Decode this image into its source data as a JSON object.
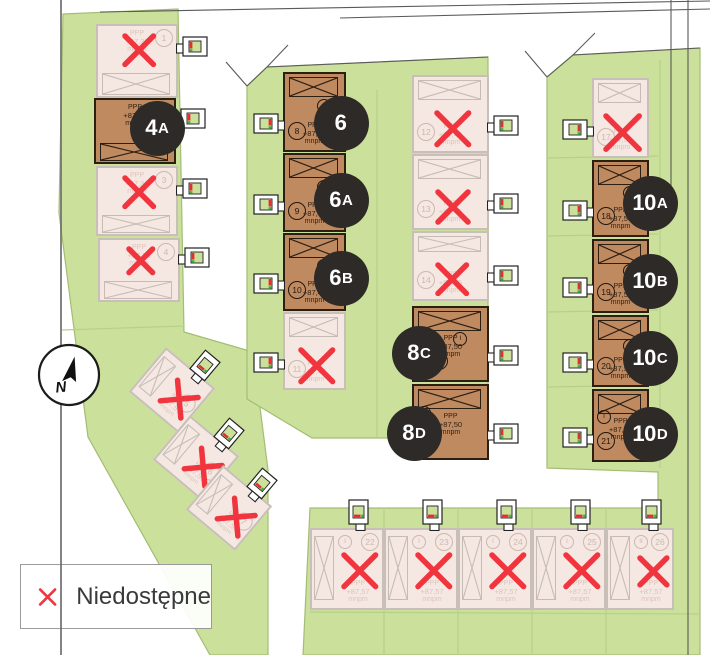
{
  "legend": {
    "label": "Niedostępne",
    "x_color": "#f0353f"
  },
  "compass": {
    "label": "N"
  },
  "colors": {
    "green": "#cbe19b",
    "green_border": "#a3bd74",
    "green_lines": "#b6d088",
    "road": "#ffffff",
    "available_fill": "#c08a61",
    "available_border": "#2b1f12",
    "unavailable_fill": "#f5e8e2",
    "unavailable_border": "#c8bfb9",
    "unavailable_x": "#f0353f",
    "label_circle": "#2d2a27",
    "label_text": "#ffffff",
    "boundary_line": "#6e6e6e"
  },
  "elevation_prefix": "PPP",
  "elevation_unit": "mnpm",
  "map": {
    "buildings": [
      {
        "plot": "1",
        "status": "unavailable",
        "x": 96,
        "y": 24,
        "w": 82,
        "h": 74,
        "hatch": "bottom",
        "drive": "right",
        "plot_pos": "tr",
        "tpos": "top",
        "elev": "+87,33"
      },
      {
        "name": "4A",
        "status": "available",
        "x": 94,
        "y": 98,
        "w": 82,
        "h": 66,
        "hatch": "bottom",
        "drive": "right",
        "tpos": "top",
        "elev": "+87,33",
        "label": [
          157,
          128
        ]
      },
      {
        "plot": "3",
        "status": "unavailable",
        "x": 96,
        "y": 166,
        "w": 82,
        "h": 70,
        "hatch": "bottom",
        "drive": "right",
        "plot_pos": "tr",
        "tpos": "top",
        "elev": "+87,33"
      },
      {
        "plot": "4",
        "status": "unavailable",
        "x": 98,
        "y": 238,
        "w": 82,
        "h": 64,
        "hatch": "bottom",
        "drive": "right",
        "plot_pos": "tr",
        "tpos": "top",
        "elev": "+87,33"
      },
      {
        "name": "6",
        "plot": "8",
        "roman": "I",
        "roman_pos": "mid",
        "status": "available",
        "x": 283,
        "y": 72,
        "w": 63,
        "h": 80,
        "hatch": "top",
        "drive": "left",
        "plot_pos": "bl",
        "tpos": "bottom",
        "elev": "+87,45",
        "label": [
          341,
          123
        ]
      },
      {
        "name": "6A",
        "plot": "9",
        "roman": "II",
        "roman_pos": "mid",
        "status": "available",
        "x": 283,
        "y": 153,
        "w": 63,
        "h": 79,
        "hatch": "top",
        "drive": "left",
        "plot_pos": "bl",
        "tpos": "bottom",
        "elev": "+87,45",
        "label": [
          341,
          200
        ]
      },
      {
        "name": "6B",
        "plot": "10",
        "roman": "II",
        "roman_pos": "mid",
        "status": "available",
        "x": 283,
        "y": 233,
        "w": 63,
        "h": 78,
        "hatch": "top",
        "drive": "left",
        "plot_pos": "bl",
        "tpos": "bottom",
        "elev": "+87,45",
        "label": [
          341,
          278
        ]
      },
      {
        "plot": "11",
        "status": "unavailable",
        "x": 283,
        "y": 312,
        "w": 63,
        "h": 78,
        "hatch": "top",
        "drive": "left",
        "plot_pos": "bl",
        "tpos": "bottom",
        "elev": "+87,45"
      },
      {
        "plot": "12",
        "status": "unavailable",
        "x": 412,
        "y": 75,
        "w": 77,
        "h": 78,
        "hatch": "top",
        "drive": "right",
        "plot_pos": "bl",
        "tpos": "bottom",
        "elev": "+87,45"
      },
      {
        "plot": "13",
        "status": "unavailable",
        "x": 412,
        "y": 154,
        "w": 77,
        "h": 76,
        "hatch": "top",
        "drive": "right",
        "plot_pos": "bl",
        "tpos": "bottom",
        "elev": "+87,45"
      },
      {
        "plot": "14",
        "status": "unavailable",
        "x": 412,
        "y": 231,
        "w": 77,
        "h": 70,
        "hatch": "top",
        "drive": "right",
        "plot_pos": "bl",
        "tpos": "bottom",
        "elev": "+87,45"
      },
      {
        "name": "8C",
        "plot": "15",
        "roman": "I",
        "roman_pos": "mid",
        "status": "available",
        "x": 412,
        "y": 306,
        "w": 77,
        "h": 76,
        "hatch": "top",
        "drive": "right",
        "plot_pos": "blc",
        "tpos": "top",
        "elev": "+87,50",
        "label": [
          419,
          353
        ]
      },
      {
        "name": "8D",
        "roman": "I",
        "roman_pos": "tl",
        "status": "available",
        "x": 412,
        "y": 384,
        "w": 77,
        "h": 76,
        "hatch": "top",
        "drive": "right",
        "tpos": "top",
        "elev": "+87,50",
        "label": [
          414,
          433
        ]
      },
      {
        "plot": "17",
        "status": "unavailable",
        "x": 592,
        "y": 78,
        "w": 57,
        "h": 80,
        "hatch": "top",
        "drive": "left",
        "plot_pos": "bl",
        "tpos": "bottom",
        "elev": "+87,50"
      },
      {
        "name": "10A",
        "plot": "18",
        "roman": "I",
        "roman_pos": "mid",
        "status": "available",
        "x": 592,
        "y": 160,
        "w": 57,
        "h": 77,
        "hatch": "top",
        "drive": "left",
        "plot_pos": "bl",
        "tpos": "bottom",
        "elev": "+87,50",
        "label": [
          650,
          203
        ]
      },
      {
        "name": "10B",
        "plot": "19",
        "roman": "II",
        "roman_pos": "mid",
        "status": "available",
        "x": 592,
        "y": 239,
        "w": 57,
        "h": 74,
        "hatch": "top",
        "drive": "left",
        "plot_pos": "bl",
        "tpos": "bottom",
        "elev": "+87,50",
        "label": [
          650,
          281
        ]
      },
      {
        "name": "10C",
        "plot": "20",
        "roman": "II",
        "roman_pos": "mid",
        "status": "available",
        "x": 592,
        "y": 315,
        "w": 57,
        "h": 72,
        "hatch": "top",
        "drive": "left",
        "plot_pos": "bl",
        "tpos": "bottom",
        "elev": "+87,50",
        "label": [
          650,
          358
        ]
      },
      {
        "name": "10D",
        "plot": "21",
        "roman": "I",
        "roman_pos": "tl",
        "status": "available",
        "x": 592,
        "y": 389,
        "w": 57,
        "h": 73,
        "hatch": "top",
        "drive": "left",
        "plot_pos": "bl",
        "tpos": "top",
        "elev": "+87,50",
        "label": [
          650,
          434
        ]
      },
      {
        "plot": "22",
        "roman": "I",
        "roman_pos": "tl2",
        "status": "unavailable",
        "x": 310,
        "y": 528,
        "w": 74,
        "h": 82,
        "hatch": "left",
        "drive": "top",
        "plot_pos": "tr",
        "tpos": "bottom",
        "elev": "+87,57"
      },
      {
        "plot": "23",
        "roman": "I",
        "roman_pos": "tl2",
        "status": "unavailable",
        "x": 384,
        "y": 528,
        "w": 74,
        "h": 82,
        "hatch": "left",
        "drive": "top",
        "plot_pos": "tr",
        "tpos": "bottom",
        "elev": "+87,57"
      },
      {
        "plot": "24",
        "roman": "I",
        "roman_pos": "tl2",
        "status": "unavailable",
        "x": 458,
        "y": 528,
        "w": 74,
        "h": 82,
        "hatch": "left",
        "drive": "top",
        "plot_pos": "tr",
        "tpos": "bottom",
        "elev": "+87,57"
      },
      {
        "plot": "25",
        "roman": "I",
        "roman_pos": "tl2",
        "status": "unavailable",
        "x": 532,
        "y": 528,
        "w": 74,
        "h": 82,
        "hatch": "left",
        "drive": "top",
        "plot_pos": "tr",
        "tpos": "bottom",
        "elev": "+87,57"
      },
      {
        "plot": "26",
        "roman": "II",
        "roman_pos": "tl2",
        "status": "unavailable",
        "x": 606,
        "y": 528,
        "w": 68,
        "h": 82,
        "hatch": "left",
        "drive": "top",
        "plot_pos": "tr",
        "tpos": "bottom",
        "elev": "+87,57"
      },
      {
        "plot": "5",
        "status": "unavailable",
        "x": 140,
        "y": 361,
        "w": 64,
        "h": 58,
        "rot": 40,
        "hatch": "left",
        "drive": "top",
        "plot_pos": "mr",
        "tpos": "bottom",
        "elev": "+87,57"
      },
      {
        "plot": "6",
        "status": "unavailable",
        "x": 164,
        "y": 429,
        "w": 64,
        "h": 58,
        "rot": 40,
        "hatch": "left",
        "drive": "top",
        "plot_pos": "mr",
        "tpos": "bottom",
        "elev": "+87,57"
      },
      {
        "plot": "7",
        "status": "unavailable",
        "x": 197,
        "y": 479,
        "w": 64,
        "h": 58,
        "rot": 40,
        "hatch": "left",
        "drive": "top",
        "plot_pos": "mr",
        "tpos": "bottom",
        "elev": "+87,57"
      }
    ]
  }
}
